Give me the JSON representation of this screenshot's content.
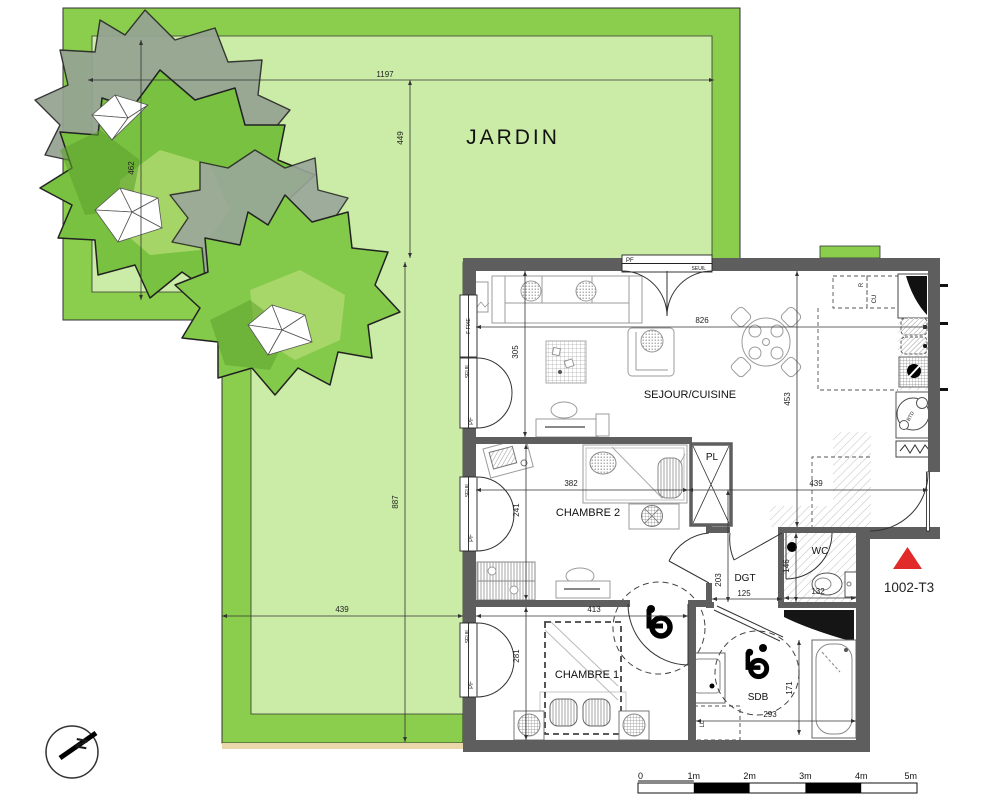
{
  "plan": {
    "unit": "1002-T3"
  },
  "garden": {
    "label": "JARDIN"
  },
  "rooms": {
    "sejour_cuisine": "SEJOUR/CUISINE",
    "chambre2": "CHAMBRE 2",
    "chambre1": "CHAMBRE 1",
    "sdb": "SDB",
    "wc": "WC",
    "dgt": "DGT",
    "pl": "PL"
  },
  "labels": {
    "pf": "PF",
    "seuil": "SEUIL",
    "f_fixe": "F FIXE",
    "r": "R",
    "cu": "CU",
    "btd": "BTD",
    "ll": "LL",
    "north": "N"
  },
  "dims": {
    "d1197": "1197",
    "d449": "449",
    "d462": "462",
    "d887": "887",
    "d439_garden": "439",
    "d826": "826",
    "d453": "453",
    "d305": "305",
    "d382": "382",
    "d241": "241",
    "d413": "413",
    "d281": "281",
    "d439_entry": "439",
    "d203": "203",
    "d125": "125",
    "d146": "146",
    "d132": "132",
    "d171": "171",
    "d293": "293"
  },
  "scale_bar": {
    "labels": [
      "0",
      "1m",
      "2m",
      "3m",
      "4m",
      "5m"
    ]
  },
  "colors": {
    "garden_border": "#8bce4e",
    "garden_inner": "#cbeca6",
    "wall": "#5e5e5e",
    "tree_green": "#79c140",
    "tree_gray": "#95a392",
    "marker_red": "#e12b2b",
    "soil": "#ead7ab"
  }
}
